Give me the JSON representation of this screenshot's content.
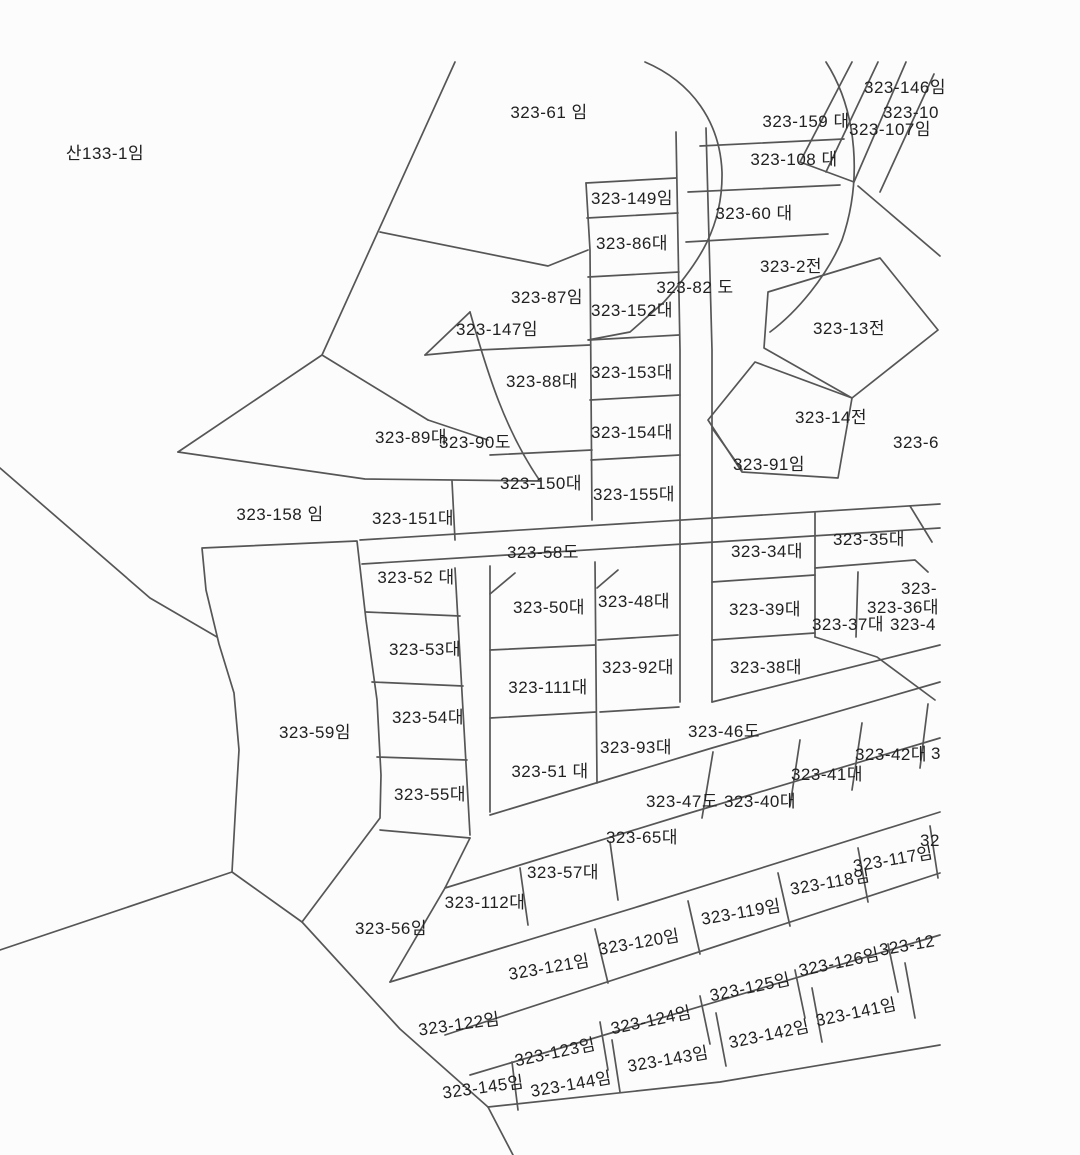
{
  "map": {
    "type": "cadastral-parcel-map",
    "background_color": "#fcfcfc",
    "line_color": "#565656",
    "label_color": "#212121",
    "highlight_fill": "#f8e6ee",
    "highlighted_parcel": "323-59임",
    "labels": [
      {
        "text": "산133-1임",
        "x": 105,
        "y": 153
      },
      {
        "text": "323-61 임",
        "x": 549,
        "y": 112
      },
      {
        "text": "323-146임",
        "x": 905,
        "y": 87
      },
      {
        "text": "323-10",
        "x": 911,
        "y": 112
      },
      {
        "text": "323-159 대",
        "x": 806,
        "y": 121
      },
      {
        "text": "323-107임",
        "x": 890,
        "y": 129
      },
      {
        "text": "323-108 대",
        "x": 794,
        "y": 159
      },
      {
        "text": "323-149임",
        "x": 632,
        "y": 198
      },
      {
        "text": "323-60 대",
        "x": 754,
        "y": 213
      },
      {
        "text": "323-86대",
        "x": 632,
        "y": 243
      },
      {
        "text": "323-2전",
        "x": 791,
        "y": 266
      },
      {
        "text": "323-82 도",
        "x": 695,
        "y": 287
      },
      {
        "text": "323-87임",
        "x": 547,
        "y": 297
      },
      {
        "text": "323-152대",
        "x": 632,
        "y": 310
      },
      {
        "text": "323-147임",
        "x": 497,
        "y": 329
      },
      {
        "text": "323-13전",
        "x": 849,
        "y": 328
      },
      {
        "text": "323-153대",
        "x": 632,
        "y": 372
      },
      {
        "text": "323-88대",
        "x": 542,
        "y": 381
      },
      {
        "text": "323-14전",
        "x": 831,
        "y": 417
      },
      {
        "text": "323-89대",
        "x": 411,
        "y": 437
      },
      {
        "text": "323-90도",
        "x": 475,
        "y": 442
      },
      {
        "text": "323-154대",
        "x": 632,
        "y": 432
      },
      {
        "text": "323-6",
        "x": 916,
        "y": 442
      },
      {
        "text": "323-91임",
        "x": 769,
        "y": 464
      },
      {
        "text": "323-150대",
        "x": 541,
        "y": 483
      },
      {
        "text": "323-155대",
        "x": 634,
        "y": 494
      },
      {
        "text": "323-158 임",
        "x": 280,
        "y": 514
      },
      {
        "text": "323-151대",
        "x": 413,
        "y": 518
      },
      {
        "text": "323-58도",
        "x": 543,
        "y": 552
      },
      {
        "text": "323-35대",
        "x": 869,
        "y": 539
      },
      {
        "text": "323-34대",
        "x": 767,
        "y": 551
      },
      {
        "text": "323-52 대",
        "x": 416,
        "y": 577
      },
      {
        "text": "323-",
        "x": 919,
        "y": 588
      },
      {
        "text": "323-50대",
        "x": 549,
        "y": 607
      },
      {
        "text": "323-48대",
        "x": 634,
        "y": 601
      },
      {
        "text": "323-36대",
        "x": 903,
        "y": 607
      },
      {
        "text": "323-39대",
        "x": 765,
        "y": 609
      },
      {
        "text": "323-37대",
        "x": 848,
        "y": 624
      },
      {
        "text": "323-4",
        "x": 913,
        "y": 624
      },
      {
        "text": "323-53대",
        "x": 425,
        "y": 649
      },
      {
        "text": "323-38대",
        "x": 766,
        "y": 667
      },
      {
        "text": "323-92대",
        "x": 638,
        "y": 667
      },
      {
        "text": "323-111대",
        "x": 548,
        "y": 687
      },
      {
        "text": "323-54대",
        "x": 428,
        "y": 717
      },
      {
        "text": "323-46도",
        "x": 724,
        "y": 731
      },
      {
        "text": "323-59임",
        "x": 315,
        "y": 732
      },
      {
        "text": "323-93대",
        "x": 636,
        "y": 747
      },
      {
        "text": "323-42대",
        "x": 891,
        "y": 754
      },
      {
        "text": "3",
        "x": 936,
        "y": 753
      },
      {
        "text": "323-51 대",
        "x": 550,
        "y": 771
      },
      {
        "text": "323-41대",
        "x": 827,
        "y": 774
      },
      {
        "text": "323-55대",
        "x": 430,
        "y": 794
      },
      {
        "text": "323-47도",
        "x": 682,
        "y": 801
      },
      {
        "text": "323-40대",
        "x": 760,
        "y": 801
      },
      {
        "text": "323-65대",
        "x": 642,
        "y": 837
      },
      {
        "text": "32",
        "x": 930,
        "y": 840
      },
      {
        "text": "323-117임",
        "x": 893,
        "y": 859,
        "rot": -10
      },
      {
        "text": "323-57대",
        "x": 563,
        "y": 872
      },
      {
        "text": "323-118임",
        "x": 830,
        "y": 882,
        "rot": -10
      },
      {
        "text": "323-112대",
        "x": 485,
        "y": 902
      },
      {
        "text": "323-119임",
        "x": 741,
        "y": 912,
        "rot": -10
      },
      {
        "text": "323-56임",
        "x": 391,
        "y": 928
      },
      {
        "text": "323-12",
        "x": 907,
        "y": 945,
        "rot": -10
      },
      {
        "text": "323-120임",
        "x": 639,
        "y": 942,
        "rot": -10
      },
      {
        "text": "323-126임",
        "x": 839,
        "y": 962,
        "rot": -12
      },
      {
        "text": "323-121임",
        "x": 549,
        "y": 967,
        "rot": -10
      },
      {
        "text": "323-125임",
        "x": 750,
        "y": 987,
        "rot": -12
      },
      {
        "text": "323-141임",
        "x": 856,
        "y": 1012,
        "rot": -12
      },
      {
        "text": "323-124임",
        "x": 651,
        "y": 1020,
        "rot": -12
      },
      {
        "text": "323-122임",
        "x": 459,
        "y": 1024,
        "rot": -8
      },
      {
        "text": "323-142임",
        "x": 769,
        "y": 1034,
        "rot": -12
      },
      {
        "text": "323-123임",
        "x": 555,
        "y": 1052,
        "rot": -12
      },
      {
        "text": "323-143임",
        "x": 668,
        "y": 1059,
        "rot": -10
      },
      {
        "text": "323-145임",
        "x": 483,
        "y": 1087,
        "rot": -8
      },
      {
        "text": "323-144임",
        "x": 571,
        "y": 1084,
        "rot": -10
      }
    ]
  }
}
